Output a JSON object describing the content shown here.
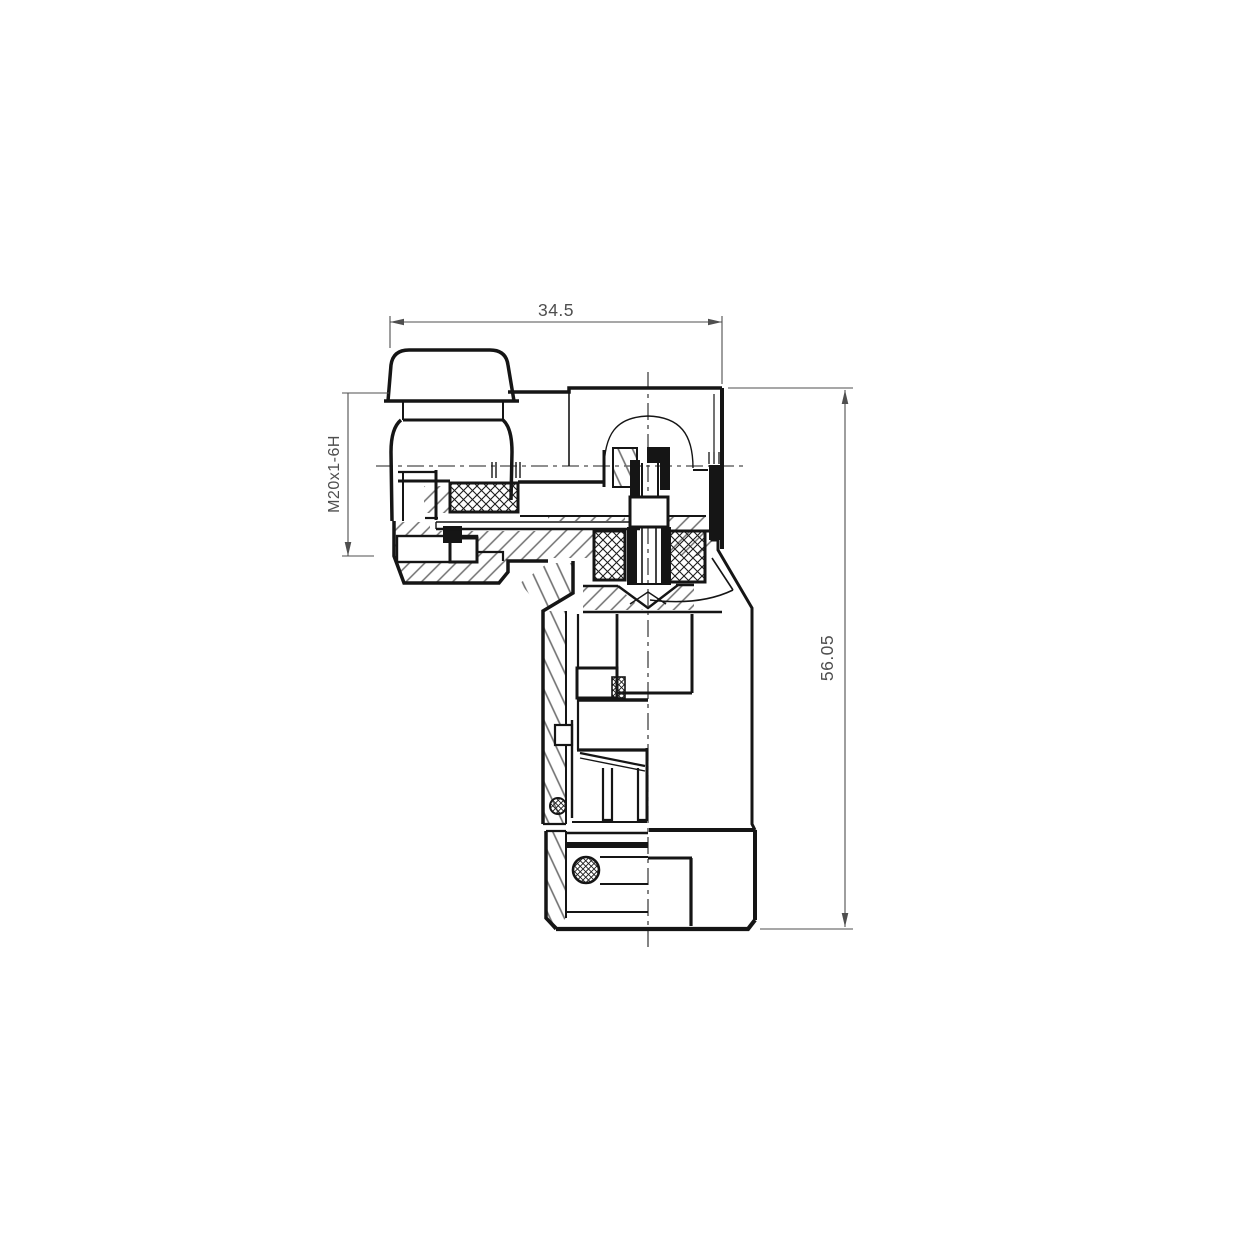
{
  "page": {
    "background": "#ffffff"
  },
  "drawing": {
    "type": "engineering-cross-section",
    "subject": "right-angle coaxial connector, half-section view",
    "line_color": "#151515",
    "dimension_color": "#4f4f4f",
    "hatch_color": "#6f6f6f",
    "dimensions": {
      "width": {
        "value": "34.5",
        "orientation": "horizontal",
        "location": "top"
      },
      "height": {
        "value": "56.05",
        "orientation": "vertical",
        "location": "right"
      },
      "thread": {
        "value": "M20x1-6H",
        "orientation": "vertical",
        "location": "left"
      }
    }
  }
}
